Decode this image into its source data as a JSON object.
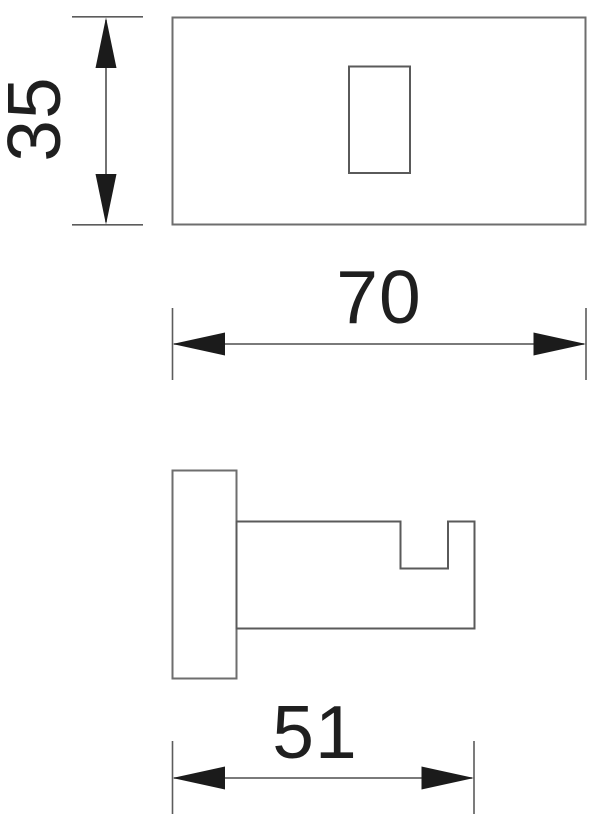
{
  "drawing": {
    "kind": "technical-drawing",
    "subject": "wall hook – dimensioned orthographic views",
    "background": "#ffffff",
    "colors": {
      "part_outline": "#6e6e6e",
      "dimension_line": "#4f4f4f",
      "extension_line": "#5c5c5c",
      "arrowhead": "#1b1b1b",
      "text": "#1f1f1f"
    },
    "views": {
      "top_view": {
        "name": "top view (face plate with mounting slot)",
        "features": [
          "outer-rectangle",
          "center-slot"
        ]
      },
      "side_view": {
        "name": "side profile (wall plate and hook arm with notch)",
        "features": [
          "wall-plate",
          "hook-arm",
          "top-notch"
        ]
      }
    },
    "dimensions": {
      "height": {
        "label": "35",
        "value": 35,
        "orientation": "vertical",
        "applies_to": "top view height / plate height"
      },
      "width": {
        "label": "70",
        "value": 70,
        "orientation": "horizontal",
        "applies_to": "top view width"
      },
      "depth": {
        "label": "51",
        "value": 51,
        "orientation": "horizontal",
        "applies_to": "side view projection depth"
      }
    }
  }
}
